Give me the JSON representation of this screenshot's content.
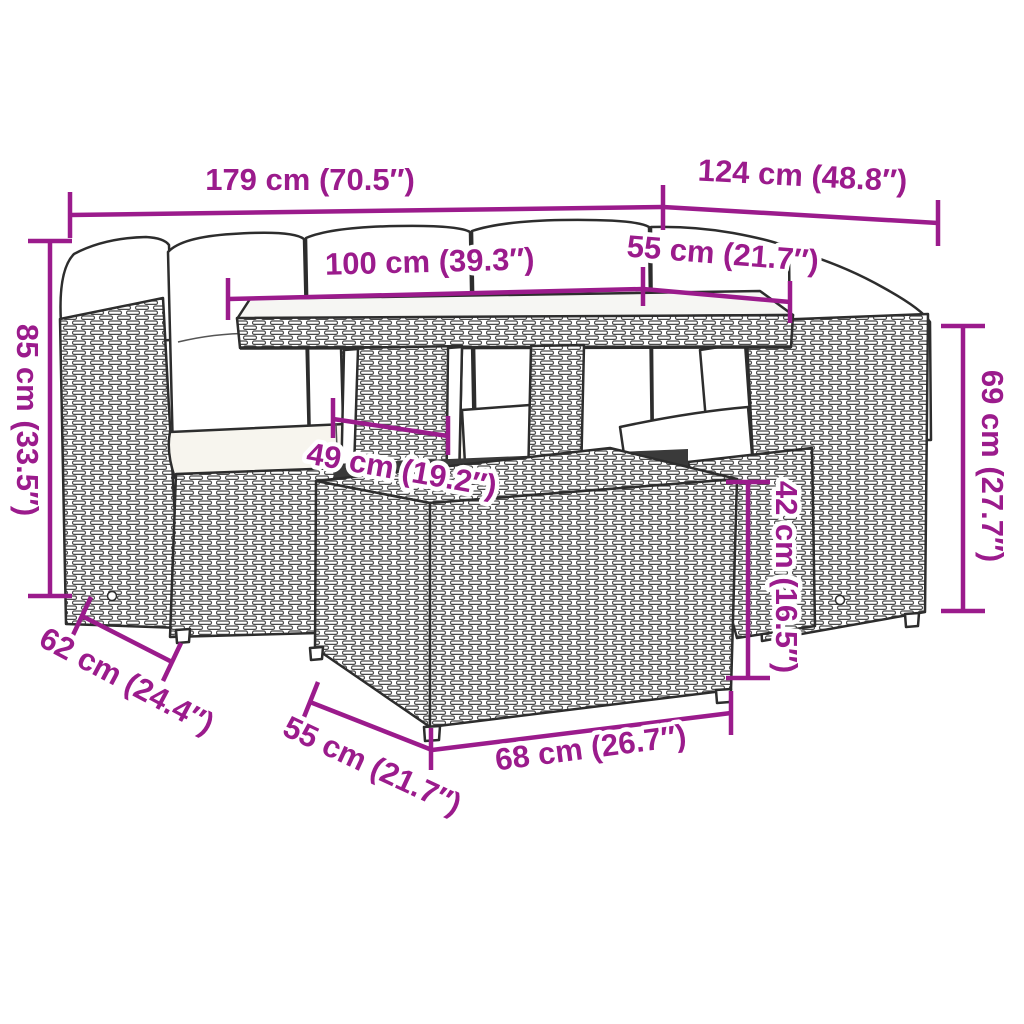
{
  "diagram": {
    "accent_color": "#9b1b8c",
    "line_color": "#2d2d2d",
    "background": "#ffffff",
    "dimensions": {
      "overall_width": "179 cm (70.5″)",
      "overall_depth": "124 cm (48.8″)",
      "table_length": "100 cm (39.3″)",
      "table_depth": "55 cm (21.7″)",
      "overall_height": "85 cm (33.5″)",
      "backrest_height": "69 cm (27.7″)",
      "table_base_width": "49 cm (19.2″)",
      "ottoman_height": "42 cm (16.5″)",
      "seat_depth": "62 cm (24.4″)",
      "ottoman_depth": "55 cm (21.7″)",
      "ottoman_width": "68 cm (26.7″)"
    }
  }
}
